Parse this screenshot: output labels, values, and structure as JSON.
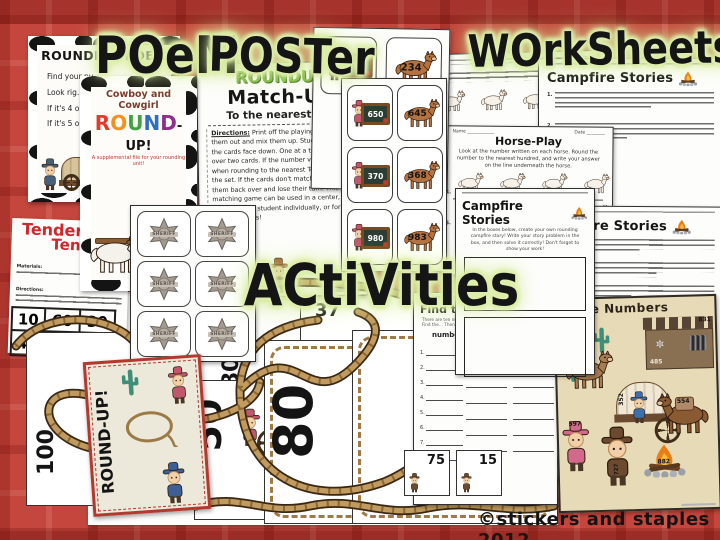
{
  "labels": {
    "poem": "POeM",
    "poster": "POSTer",
    "worksheets": "WOrkSheets",
    "activities": "ACtiVities"
  },
  "copyright": "©stickers and staples 2012",
  "colors": {
    "plaid_red": "#c4463d",
    "label_glow": "#d7e9a0",
    "title_red": "#d1262b",
    "rope": "#bd965c",
    "badge_gray": "#a39b91",
    "parchment": "#e7dab6",
    "campfire_orange": "#e87f16"
  },
  "poem_poster": {
    "title": "ROUNDING POEM",
    "lines": [
      "Find your nu…",
      "Look rig…",
      "If it's 4 or …",
      "If it's 5 or …"
    ]
  },
  "cover": {
    "kicker": "Cowboy and Cowgirl",
    "title_letters": [
      {
        "ch": "R",
        "color": "#e5392b"
      },
      {
        "ch": "O",
        "color": "#f4901e"
      },
      {
        "ch": "U",
        "color": "#3fa33f"
      },
      {
        "ch": "N",
        "color": "#2f6fc1"
      },
      {
        "ch": "D",
        "color": "#8f2f8b"
      }
    ],
    "title_suffix": "-UP!",
    "tagline": "A supplemental file for your rounding unit!"
  },
  "matchup": {
    "title_word1": "ROUNDUP",
    "title_word2": "Match-Up",
    "subtitle": "To the nearest Ten",
    "directions_label": "Directions:",
    "directions": "Print off the playing cards, cut them out and mix them up. Students turn all the cards face down. One at a time, they turn over two cards. If the number values match when rounding to the nearest Tens, they keep the set. If the cards don't match, they turn them back over and lose their turn. This matching game can be used in a center, given to each student individually, or for partner games!"
  },
  "playing_cards": {
    "row_top": {
      "cowgirl": "200",
      "horse": "234"
    },
    "rows": [
      {
        "cowgirl": "650",
        "horse": "645"
      },
      {
        "cowgirl": "370",
        "horse": "368"
      },
      {
        "cowgirl": "980",
        "horse": "983"
      }
    ]
  },
  "worksheets": {
    "name_label": "Name",
    "date_label": "Date",
    "horse_play": {
      "title": "Horse-Play",
      "directions": "Look at the number written on each horse. Round the number to the nearest hundred, and write your answer on the line underneath the horse.",
      "items": [
        "1.",
        "2.",
        "3.",
        "4.",
        "5.",
        "6.",
        "7.",
        "8."
      ]
    },
    "campfire_title": "Campfire Stories",
    "campfire_items": [
      "1.",
      "2.",
      "3.",
      "4.",
      "5.",
      "6."
    ],
    "campfire_create_directions": "In the boxes below, create your own rounding campfire story! Write your story problem in the box, and then solve it correctly! Don't forget to show your work!"
  },
  "tenderfoot": {
    "title_line1": "Tenderfoot",
    "title_line2": "Tens",
    "materials_label": "Materials:",
    "directions_label": "Directions:",
    "row1": [
      "10",
      "60",
      "30"
    ],
    "row2": [
      "40",
      "20",
      "60"
    ]
  },
  "badges": {
    "label": "SHERIFF"
  },
  "number_cards": {
    "strip": [
      "37",
      "82"
    ],
    "small": [
      "75",
      "15"
    ],
    "big": [
      "80",
      "80",
      "50",
      "100"
    ],
    "roundup_card_text": "ROUND-UP!"
  },
  "find_sheet": {
    "title": "Find t…",
    "hint1": "There are ten nu…",
    "hint2": "Find the… Then rou…",
    "numbers_label": "numbers",
    "items": [
      "1.",
      "2.",
      "3.",
      "4.",
      "5.",
      "6.",
      "7.",
      "8."
    ]
  },
  "scene": {
    "title": "the Numbers",
    "numbers": {
      "jail_roof": "831",
      "jail_wall": "485",
      "horse": "170",
      "wagon": "352",
      "mule": "554",
      "cowgirl_hat": "597",
      "cowboy_leg": "727",
      "campfire": "882"
    }
  }
}
